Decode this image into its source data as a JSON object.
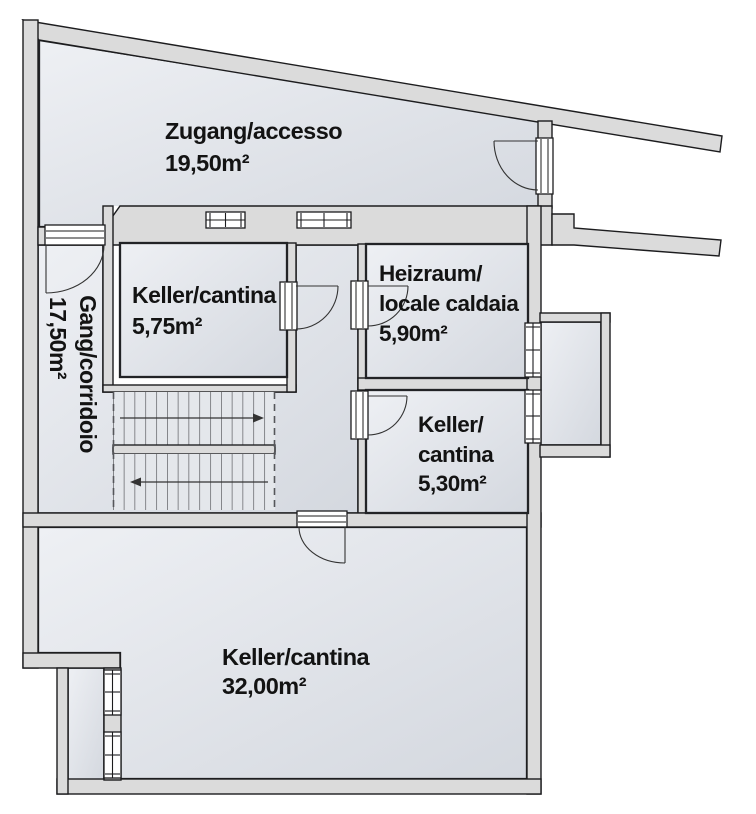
{
  "colors": {
    "background": "#ffffff",
    "wall_fill": "#dbdbdb",
    "outline": "#1c1c1e",
    "room_border": "#222326",
    "room_fill_light": "#eef0f4",
    "room_fill_dark": "#d4d8df",
    "stair_fill": "#e4e7eb",
    "stair_tread": "#3f3f44",
    "window_fill": "#ffffff",
    "label_text": "#131313",
    "dash_color": "#55565a",
    "arrow_color": "#333333"
  },
  "rooms": [
    {
      "id": "zugang",
      "line1": "Zugang/accesso",
      "area": "19,50m²"
    },
    {
      "id": "gang",
      "line1": "Gang/corridoio",
      "area": "17,50m²"
    },
    {
      "id": "keller-575",
      "line1": "Keller/cantina",
      "area": "5,75m²"
    },
    {
      "id": "heizraum",
      "line1": "Heizraum/",
      "line2": "locale caldaia",
      "area": "5,90m²"
    },
    {
      "id": "keller-530",
      "line1": "Keller/",
      "line2": "cantina",
      "area": "5,30m²"
    },
    {
      "id": "keller-3200",
      "line1": "Keller/cantina",
      "area": "32,00m²"
    }
  ]
}
